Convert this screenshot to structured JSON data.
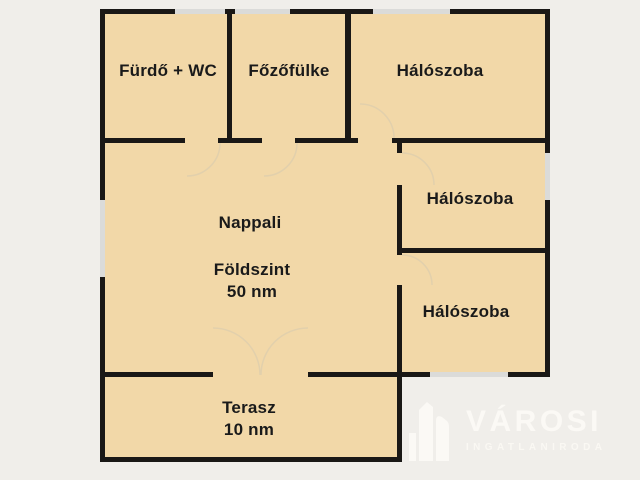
{
  "colors": {
    "background": "#f0eeea",
    "room_fill": "#f2d8a8",
    "wall": "#1a1816",
    "window": "#dbdbd9",
    "door_arc": "#e2d0ac",
    "label_text": "#1a1a1a",
    "watermark_white": "#fbf9f5"
  },
  "rooms": {
    "bathroom": {
      "label": "Fürdő + WC"
    },
    "kitchenette": {
      "label": "Főzőfülke"
    },
    "bedroom_top": {
      "label": "Hálószoba"
    },
    "bedroom_middle": {
      "label": "Hálószoba"
    },
    "bedroom_bottom": {
      "label": "Hálószoba"
    },
    "living_room": {
      "label": "Nappali",
      "floor_label": "Földszint",
      "area": "50 nm"
    },
    "terrace": {
      "label": "Terasz",
      "area": "10 nm"
    }
  },
  "watermark": {
    "brand": "VÁROSI",
    "tagline": "INGATLANIRODA"
  }
}
